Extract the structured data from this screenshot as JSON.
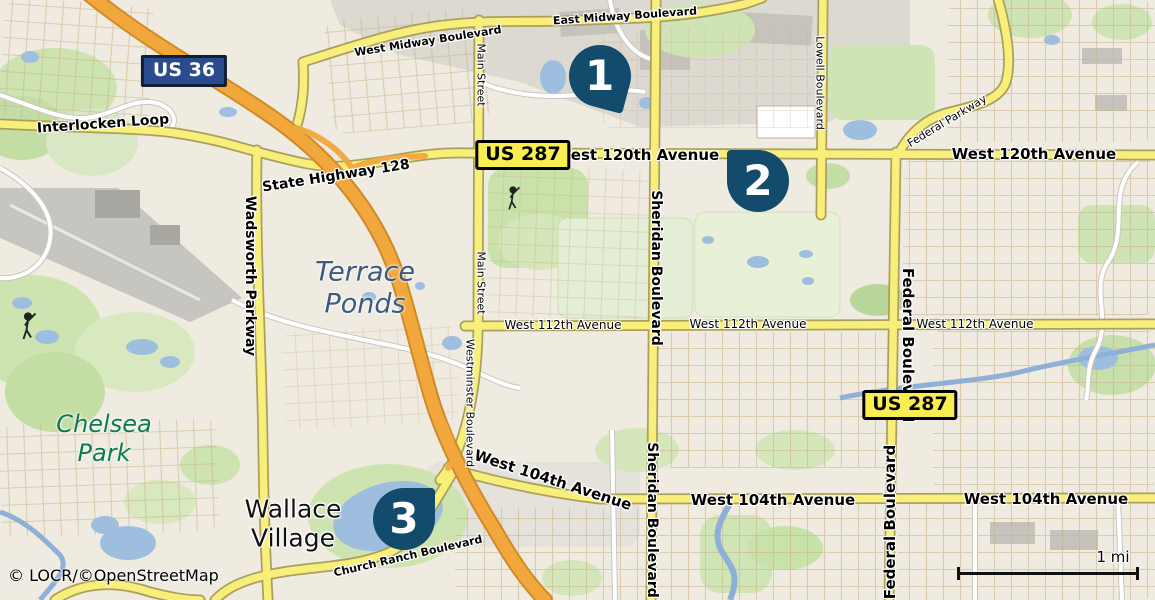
{
  "attribution": "© LOCR/©OpenStreetMap",
  "scale": {
    "label": "1 mi"
  },
  "shields": {
    "us36": "US 36",
    "us287": "US 287"
  },
  "markers": {
    "m1": "1",
    "m2": "2",
    "m3": "3"
  },
  "roads": {
    "interlocken": "Interlocken Loop",
    "sh128": "State Highway 128",
    "west_midway": "West Midway Boulevard",
    "east_midway": "East Midway Boulevard",
    "main_street": "Main Street",
    "w120": "West 120th Avenue",
    "lowell": "Lowell Boulevard",
    "federal_pkwy": "Federal Parkway",
    "sheridan": "Sheridan Boulevard",
    "w112": "West 112th Avenue",
    "westminster": "Westminster Boulevard",
    "federal_blvd": "Federal Boulevard",
    "wadsworth": "Wadsworth Parkway",
    "w104": "West 104th Avenue",
    "church_ranch": "Church Ranch Boulevard"
  },
  "places": {
    "terrace_1": "Terrace",
    "terrace_2": "Ponds",
    "chelsea_1": "Chelsea",
    "chelsea_2": "Park",
    "wallace_1": "Wallace",
    "wallace_2": "Village"
  },
  "colors": {
    "marker": "#134b6d",
    "motorway": "#f2a73d",
    "primary": "#f8ef7b",
    "water": "#9dbede",
    "shield_blue": "#2a4c8e",
    "shield_yellow": "#f8ee52",
    "park_green": "#cde4b0",
    "land": "#f0ebe0"
  }
}
